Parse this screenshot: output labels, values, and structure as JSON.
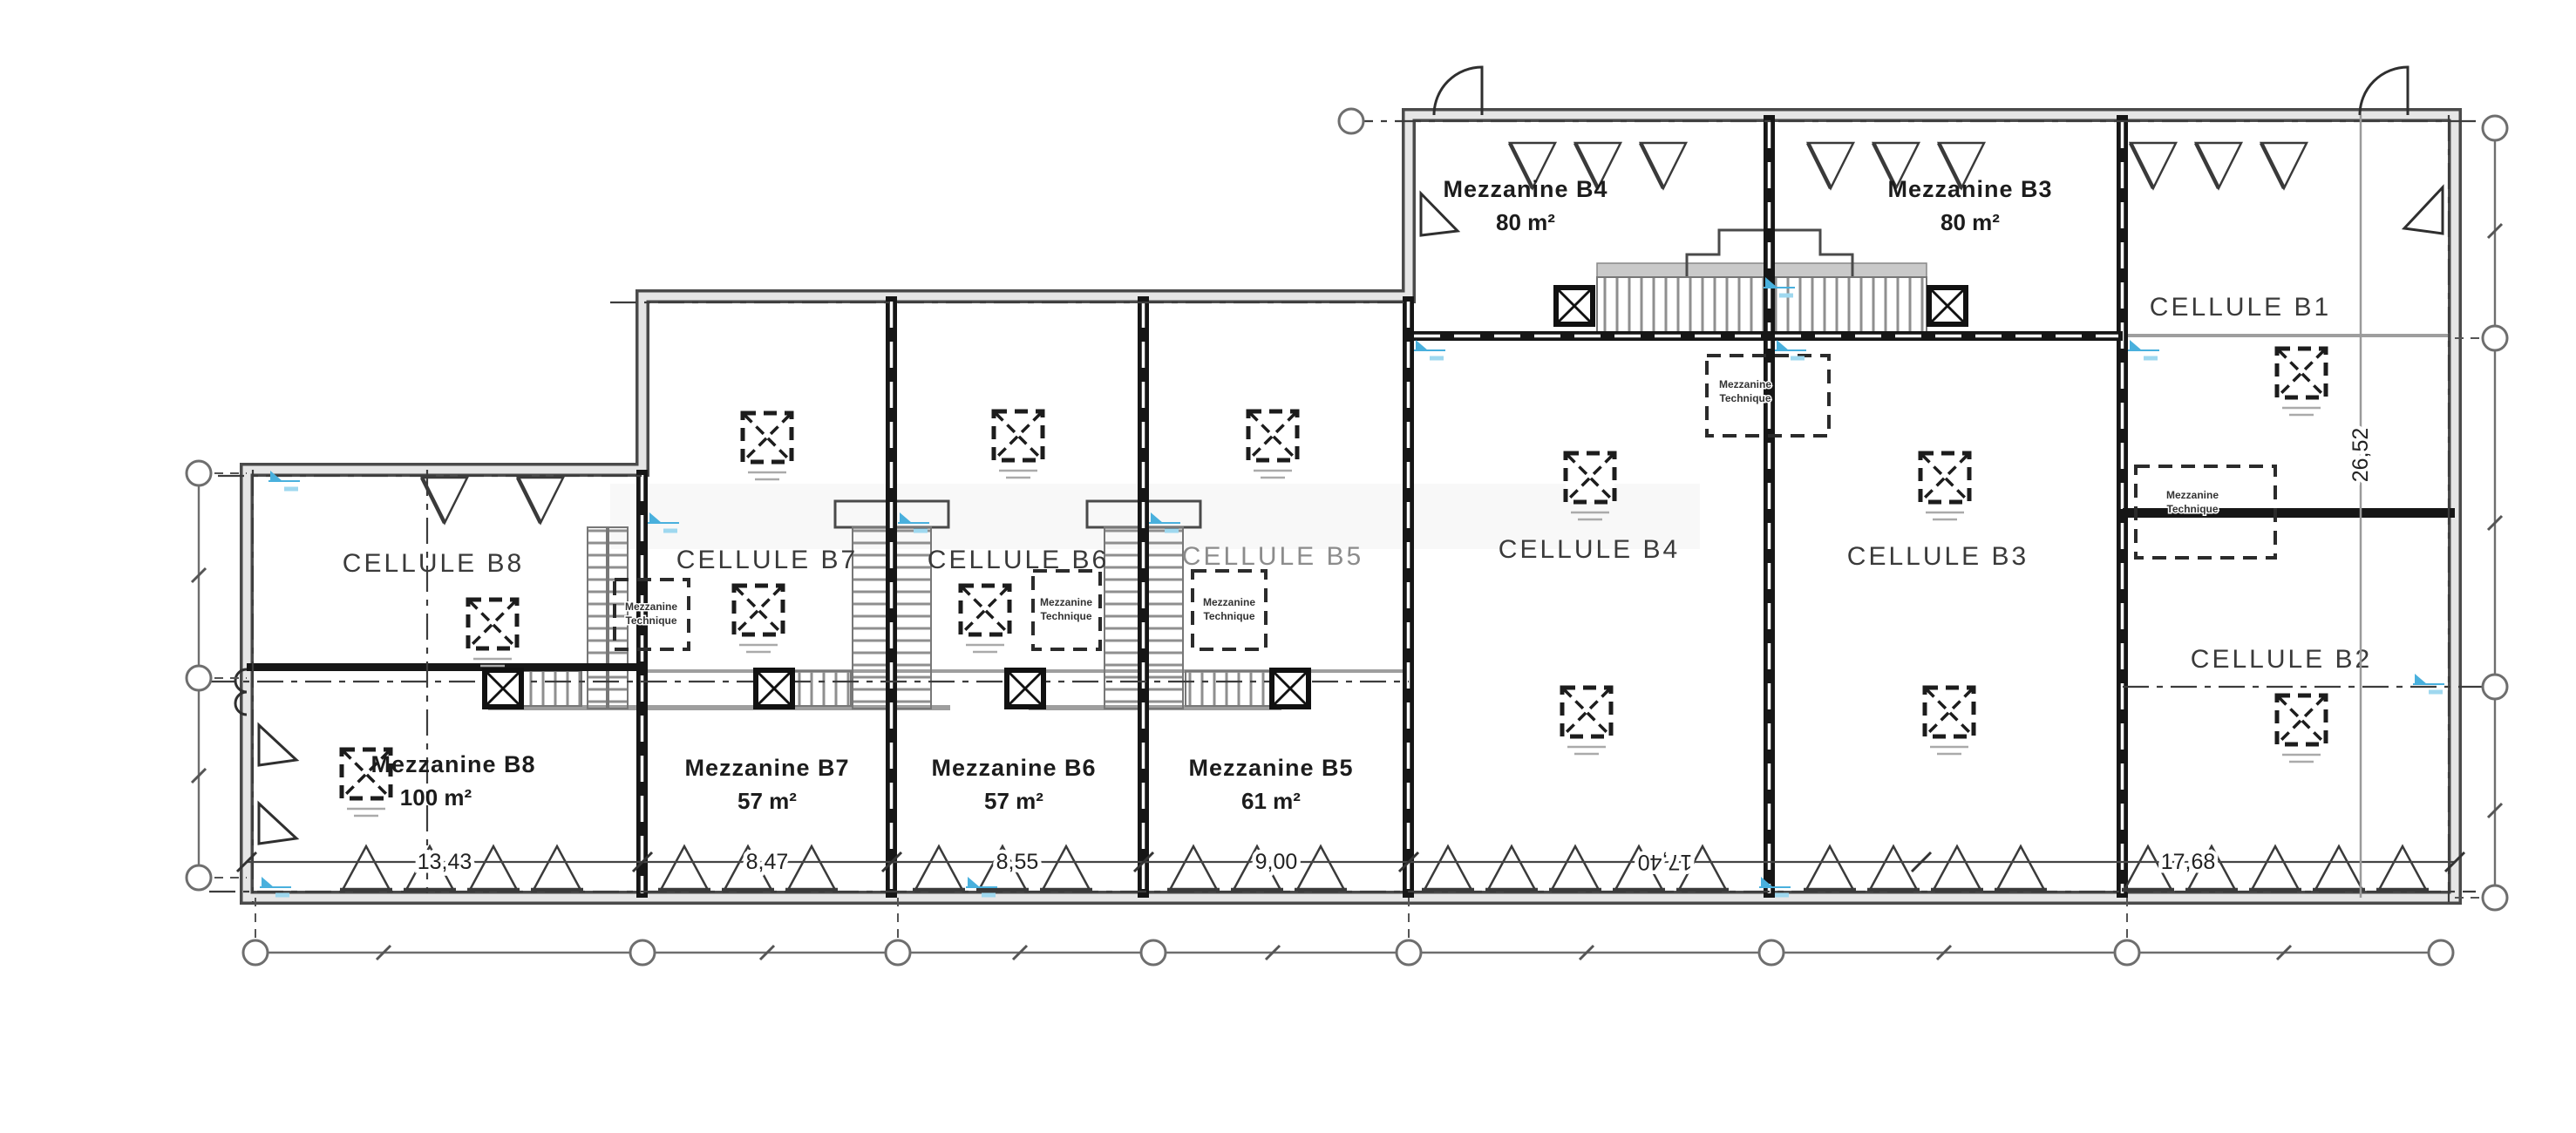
{
  "plan": {
    "cells": {
      "b1": {
        "label": "CELLULE B1"
      },
      "b2": {
        "label": "CELLULE B2"
      },
      "b3": {
        "label": "CELLULE B3"
      },
      "b4": {
        "label": "CELLULE B4"
      },
      "b5": {
        "label": "CELLULE B5"
      },
      "b6": {
        "label": "CELLULE B6"
      },
      "b7": {
        "label": "CELLULE B7"
      },
      "b8": {
        "label": "CELLULE B8"
      }
    },
    "mezzanines": {
      "b3": {
        "label": "Mezzanine B3",
        "area": "80 m²"
      },
      "b4": {
        "label": "Mezzanine B4",
        "area": "80 m²"
      },
      "b5": {
        "label": "Mezzanine B5",
        "area": "61 m²"
      },
      "b6": {
        "label": "Mezzanine B6",
        "area": "57 m²"
      },
      "b7": {
        "label": "Mezzanine B7",
        "area": "57 m²"
      },
      "b8": {
        "label": "Mezzanine B8",
        "area": "100 m²"
      }
    },
    "tech_note": {
      "line1": "Mezzanine",
      "line2": "Technique"
    },
    "dimensions": {
      "bottom": [
        "13,43",
        "8,47",
        "8,55",
        "9,00",
        "17,40",
        "17,68"
      ],
      "vertical_right": "26,52"
    },
    "colors": {
      "wall": "#161616",
      "slab_gray": "#9e9e9e",
      "marker_blue": "#49b0dd"
    }
  }
}
